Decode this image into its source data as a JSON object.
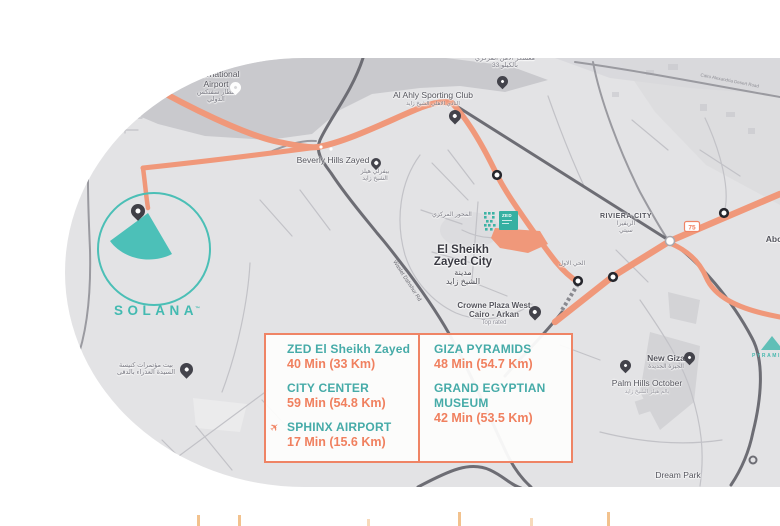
{
  "colors": {
    "teal": "#46aba8",
    "orange_text": "#f0805f",
    "road_orange": "#f0987a",
    "box_border": "#ef8465",
    "map_bg": "#e3e3e5",
    "dark_zone": "#c9c9cd",
    "road_dark": "#6d6d74",
    "label_dark": "#54545c"
  },
  "logo": {
    "name": "SOLANA",
    "tm": "™"
  },
  "zed": {
    "text": "ZED"
  },
  "badge": {
    "route": "75"
  },
  "infobox": {
    "left": [
      {
        "icon": "",
        "title": "ZED El Sheikh Zayed",
        "value": "40 Min (33 Km)"
      },
      {
        "icon": "",
        "title": "CITY CENTER",
        "value": "59 Min (54.8 Km)"
      },
      {
        "icon": "✈",
        "title": "SPHINX AIRPORT",
        "value": "17 Min  (15.6 Km)"
      }
    ],
    "right": [
      {
        "icon": "",
        "title": "GIZA PYRAMIDS",
        "value": "48 Min (54.7 Km)"
      },
      {
        "icon": "",
        "title": "GRAND EGYPTIAN MUSEUM",
        "value": "42 Min  (53.5 Km)"
      }
    ]
  },
  "places": {
    "airport": {
      "en1": "International",
      "en2": "Airport",
      "ar1": "مطار سفنكس",
      "ar2": "الدولي"
    },
    "camp": {
      "ar1": "معسكر الأمن المركزي",
      "ar2": "بالكيلو 33"
    },
    "alahly": {
      "en": "Al Ahly Sporting Club",
      "ar": "النادي الاهلي الشيخ زايد"
    },
    "beverly": {
      "en": "Beverly Hills Zayed",
      "ar1": "بيفرلي هيلز",
      "ar2": "الشيخ زايد"
    },
    "zayed": {
      "en1": "El Sheikh",
      "en2": "Zayed City",
      "ar1": "مدينة",
      "ar2": "الشيخ زايد"
    },
    "mehwar": {
      "ar": "المحور المركزي"
    },
    "hay": {
      "ar": "الحي الاول"
    },
    "riviera": {
      "en": "RIVIERA CITY",
      "ar1": "الريفيرا",
      "ar2": "سيتي"
    },
    "abo": {
      "en": "Abo"
    },
    "crowne": {
      "en1": "Crowne Plaza West",
      "en2": "Cairo - Arkan",
      "sub": "Top rated"
    },
    "church": {
      "ar1": "بيت مؤتمرات كنيسة",
      "ar2": "السيدة العذراء بالدقى"
    },
    "newgiza": {
      "en": "New Giza",
      "ar": "الجيزة الجديدة"
    },
    "palmhills": {
      "en": "Palm Hills October",
      "ar": "بالم هيلز الشيخ زايد"
    },
    "dreampark": {
      "en": "Dream Park"
    },
    "pyramids": {
      "en": "PYRAMIDS"
    },
    "waslet": {
      "en": "Waslet Dahshur Rd"
    },
    "cairoalex": {
      "en": "Cairo Alexandria Desert Road"
    }
  }
}
